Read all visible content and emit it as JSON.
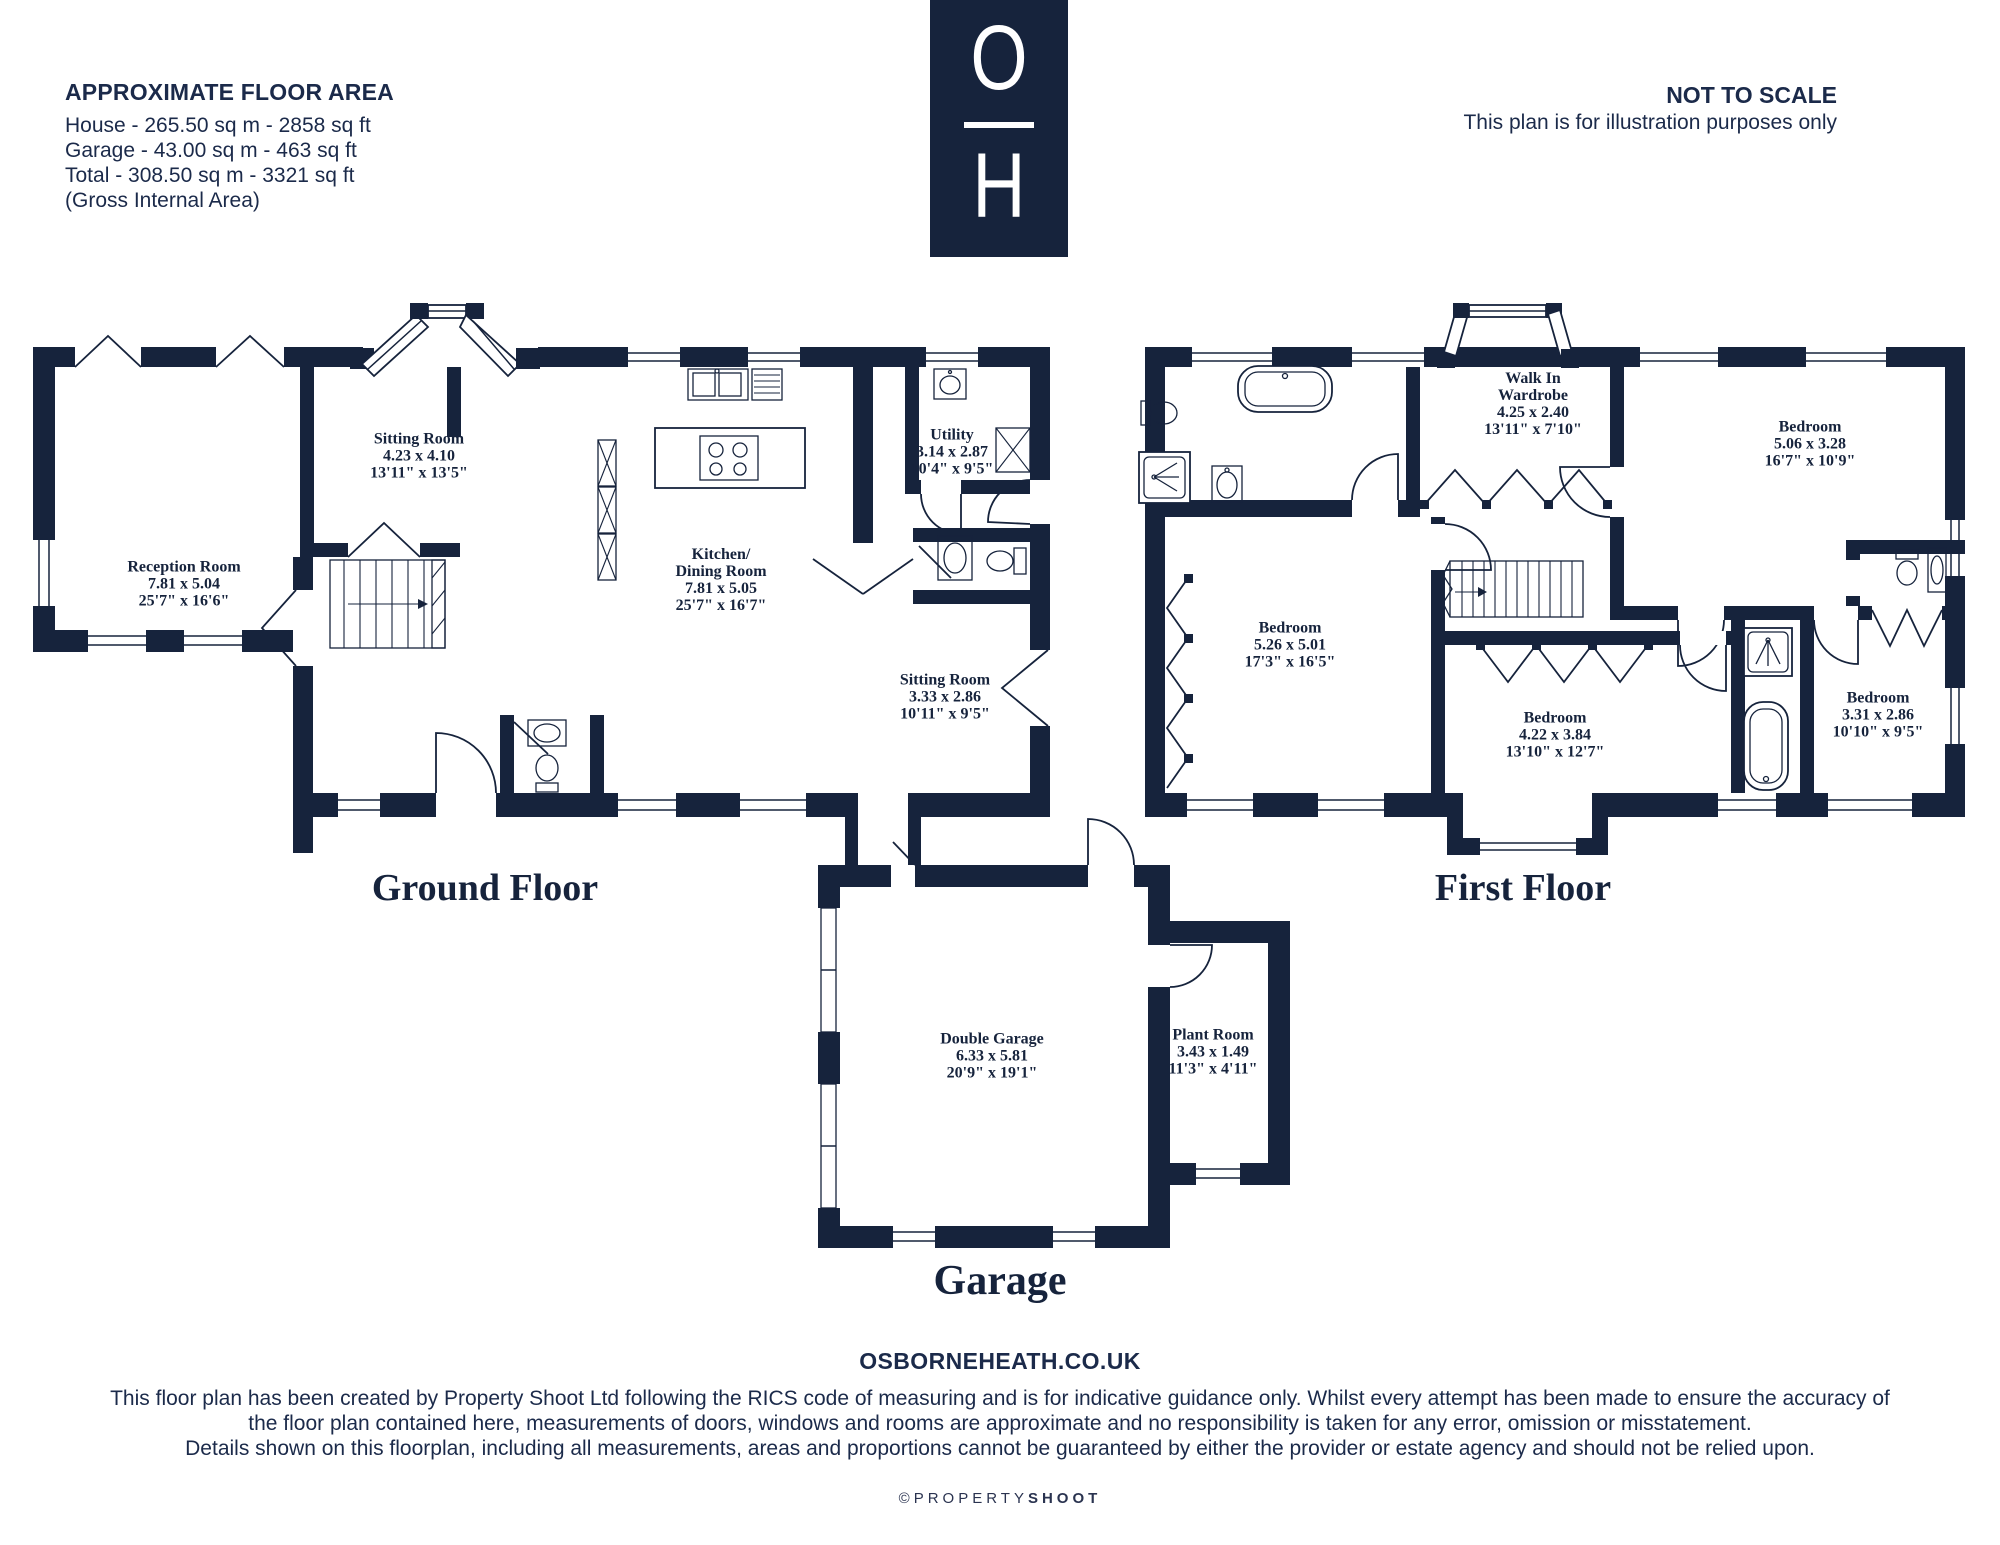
{
  "colors": {
    "navy": "#16233c",
    "background": "#ffffff"
  },
  "header": {
    "floor_area": {
      "title": "APPROXIMATE FLOOR AREA",
      "lines": [
        "House - 265.50 sq m - 2858 sq ft",
        "Garage - 43.00 sq m - 463 sq ft",
        "Total - 308.50 sq m - 3321 sq ft",
        "(Gross Internal Area)"
      ]
    },
    "logo": {
      "letter_top": "O",
      "letter_bottom": "H"
    },
    "scale_note": {
      "title": "NOT TO SCALE",
      "subtitle": "This plan is for illustration purposes only"
    }
  },
  "floors": {
    "ground": {
      "title": "Ground Floor",
      "rooms": [
        {
          "name": "Reception Room",
          "metric": "7.81 x 5.04",
          "imperial": "25'7\" x 16'6\""
        },
        {
          "name": "Sitting Room",
          "metric": "4.23 x 4.10",
          "imperial": "13'11\" x 13'5\""
        },
        {
          "name": "Kitchen/",
          "name2": "Dining Room",
          "metric": "7.81 x 5.05",
          "imperial": "25'7\" x 16'7\""
        },
        {
          "name": "Utility",
          "metric": "3.14 x 2.87",
          "imperial": "10'4\" x 9'5\""
        },
        {
          "name": "Sitting Room",
          "metric": "3.33 x 2.86",
          "imperial": "10'11\" x 9'5\""
        }
      ]
    },
    "first": {
      "title": "First Floor",
      "rooms": [
        {
          "name": "Walk In",
          "name2": "Wardrobe",
          "metric": "4.25 x 2.40",
          "imperial": "13'11\" x 7'10\""
        },
        {
          "name": "Bedroom",
          "metric": "5.06 x 3.28",
          "imperial": "16'7\" x 10'9\""
        },
        {
          "name": "Bedroom",
          "metric": "5.26 x 5.01",
          "imperial": "17'3\" x 16'5\""
        },
        {
          "name": "Bedroom",
          "metric": "4.22 x 3.84",
          "imperial": "13'10\" x 12'7\""
        },
        {
          "name": "Bedroom",
          "metric": "3.31 x 2.86",
          "imperial": "10'10\" x 9'5\""
        }
      ]
    },
    "garage": {
      "title": "Garage",
      "rooms": [
        {
          "name": "Double Garage",
          "metric": "6.33 x 5.81",
          "imperial": "20'9\" x 19'1\""
        },
        {
          "name": "Plant Room",
          "metric": "3.43 x 1.49",
          "imperial": "11'3\" x 4'11\""
        }
      ]
    }
  },
  "footer": {
    "website": "OSBORNEHEATH.CO.UK",
    "disclaimer": [
      "This floor plan has been created by Property Shoot Ltd following the RICS code of measuring and is for indicative guidance only. Whilst every attempt has been made to ensure the accuracy of",
      "the floor plan contained here, measurements of doors, windows and rooms are approximate and no responsibility is taken for any error, omission or misstatement.",
      "Details shown on this floorplan, including all measurements, areas and proportions cannot be guaranteed by either the provider or estate agency and should not be relied upon."
    ],
    "credit": {
      "prefix": "©PROPERTY",
      "suffix": "SHOOT"
    }
  }
}
